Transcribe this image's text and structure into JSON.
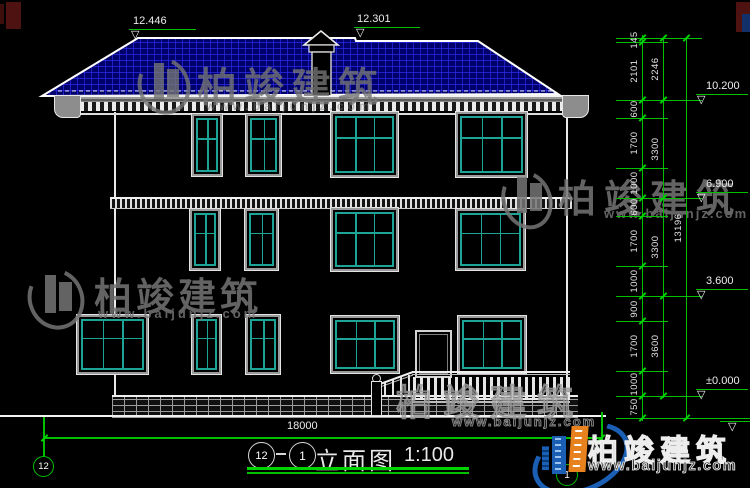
{
  "drawing": {
    "view_circle_left": "12",
    "view_circle_right": "1",
    "view_label": "立面图",
    "scale_label": "1:100",
    "width_dim": "18000",
    "grid_bubble_left": "12",
    "grid_bubble_right": "1",
    "top_elevation_markers": [
      "12.446",
      "12.301"
    ],
    "right_elevation_markers": [
      "10.200",
      "6.900",
      "3.600",
      "±0.000"
    ],
    "dim_chain_inner": [
      "145",
      "2101",
      "600",
      "1700",
      "1000",
      "600",
      "1700",
      "1000",
      "900",
      "1700",
      "1000",
      "750"
    ],
    "dim_chain_mid": [
      "2246",
      "3300",
      "3300",
      "3600"
    ],
    "dim_chain_total": "13196"
  },
  "watermark": {
    "brand": "柏竣建筑",
    "url": "www.baijunjz.com"
  },
  "logo": {
    "brand": "柏竣建筑",
    "url": "www.baijunjz.com"
  },
  "colors": {
    "dim_green": "#00c000",
    "window_teal": "#1ca496",
    "roof_blue": "#2a2ae8",
    "logo_blue": "#1a5fb4",
    "logo_orange": "#e8821e"
  }
}
